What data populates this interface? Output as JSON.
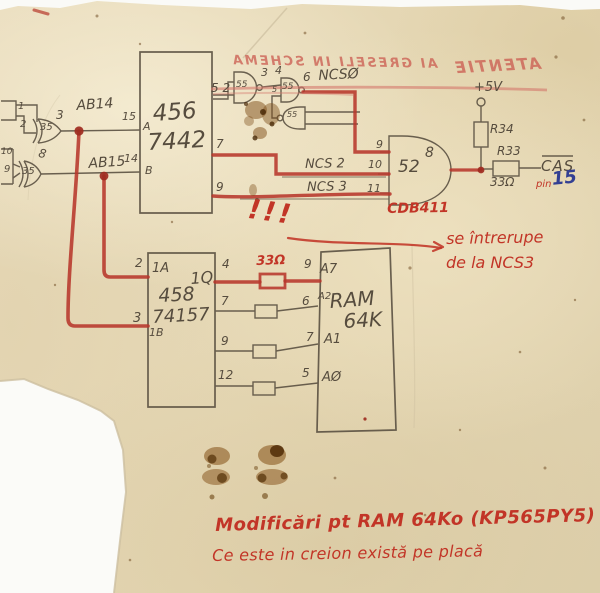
{
  "bleed_through": {
    "warning": "AI GRESELI IN SCHEMA",
    "header": "ATENTIE"
  },
  "xor_gates": {
    "ab14": {
      "chip": "35",
      "in1": "1",
      "in2": "2",
      "out": "3",
      "signal": "AB14"
    },
    "ab15": {
      "chip": "35",
      "in1": "10",
      "in2": "9",
      "out": "8",
      "signal": "AB15"
    }
  },
  "decoder": {
    "part_prefix": "456",
    "part": "7442",
    "pin_a": "15",
    "a": "A",
    "pin_b": "14",
    "b": "B",
    "top_pins": "5 2",
    "pin7": "7",
    "pin9": "9"
  },
  "nands": {
    "g1_chip": "55",
    "g1_out": "3",
    "g2_in1": "4",
    "g2_chip": "55",
    "g2_in2": "5",
    "g2_out": "6",
    "g3_chip": "55",
    "ncs0": "NCSØ"
  },
  "ncs": {
    "ncs2": "NCS 2",
    "pin10": "10",
    "ncs3": "NCS 3",
    "pin11": "11"
  },
  "output_gate": {
    "pin9": "9",
    "chip": "52",
    "pin8": "8",
    "part": "CDB411"
  },
  "cas_net": {
    "vcc": "+5V",
    "r34": "R34",
    "r33": "R33",
    "value": "33Ω",
    "cas": "CAS",
    "pin_word": "pin",
    "pin_num": "15"
  },
  "emphasis": "!!!",
  "interrupt_note": {
    "line1": "se întrerupe",
    "line2": "de la NCS3"
  },
  "mux": {
    "pin2": "2",
    "label_1a": "1A",
    "label_1q": "1Q",
    "pin4": "4",
    "part_prefix": "458",
    "pin3": "3",
    "part": "74157",
    "label_1b": "1B",
    "pin7": "7",
    "pin9": "9",
    "pin12": "12",
    "resistor": "33Ω"
  },
  "ram": {
    "pin9": "9",
    "a7": "A7",
    "pin6": "6",
    "a2": "A2",
    "name": "RAM",
    "size": "64K",
    "pin7": "7",
    "a1": "A1",
    "pin5": "5",
    "a0": "AØ"
  },
  "footer": {
    "line1": "Modificări pt RAM 64Ko (KP565PY5)",
    "line2": "Ce este in creion există pe placă"
  }
}
